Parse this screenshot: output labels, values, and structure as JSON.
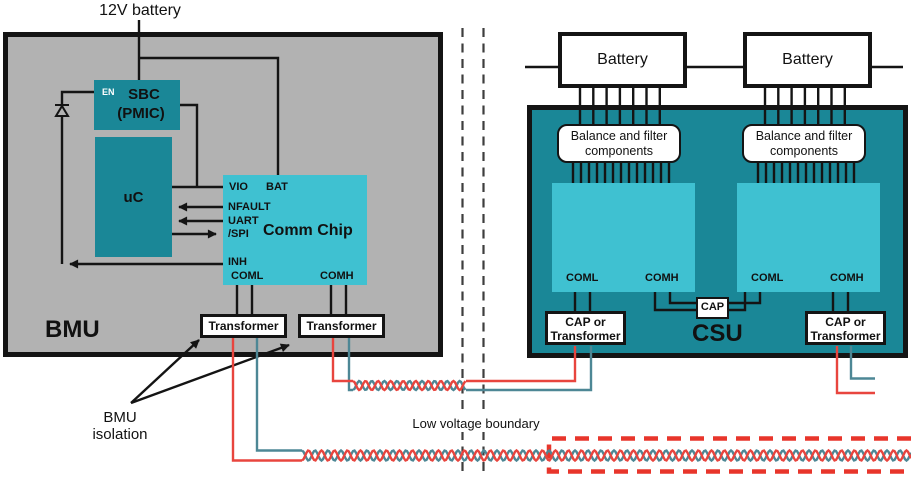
{
  "labels": {
    "battery_12v": "12V battery",
    "bmu": "BMU",
    "csu": "CSU",
    "bmu_isolation": "BMU isolation",
    "low_voltage_boundary": "Low voltage boundary"
  },
  "bmu": {
    "sbc_en": "EN",
    "sbc_title": "SBC",
    "sbc_subtitle": "(PMIC)",
    "uc": "uC",
    "comm_chip_title": "Comm Chip",
    "pins": {
      "vio": "VIO",
      "bat": "BAT",
      "nfault": "NFAULT",
      "uart": "UART",
      "spi": "/SPI",
      "inh": "INH",
      "coml": "COML",
      "comh": "COMH"
    },
    "transformer_1": "Transformer",
    "transformer_2": "Transformer"
  },
  "csu": {
    "battery_1": "Battery",
    "battery_2": "Battery",
    "balance_filter_1": "Balance and filter components",
    "balance_filter_2": "Balance and filter components",
    "chip1_coml": "COML",
    "chip1_comh": "COMH",
    "chip2_coml": "COML",
    "chip2_comh": "COMH",
    "cap": "CAP",
    "cap_or_transformer_1": "CAP or Transformer",
    "cap_or_transformer_2": "CAP or Transformer"
  },
  "colors": {
    "bmu_fill": "#b2b2b2",
    "block_teal": "#1a8797",
    "chip_cyan": "#3fc1d1",
    "wire_red": "#e8453e",
    "wire_teal": "#4d8795",
    "isolation_dash_red": "#e8352b",
    "boundary_dash_gray": "#3e3e3e"
  }
}
